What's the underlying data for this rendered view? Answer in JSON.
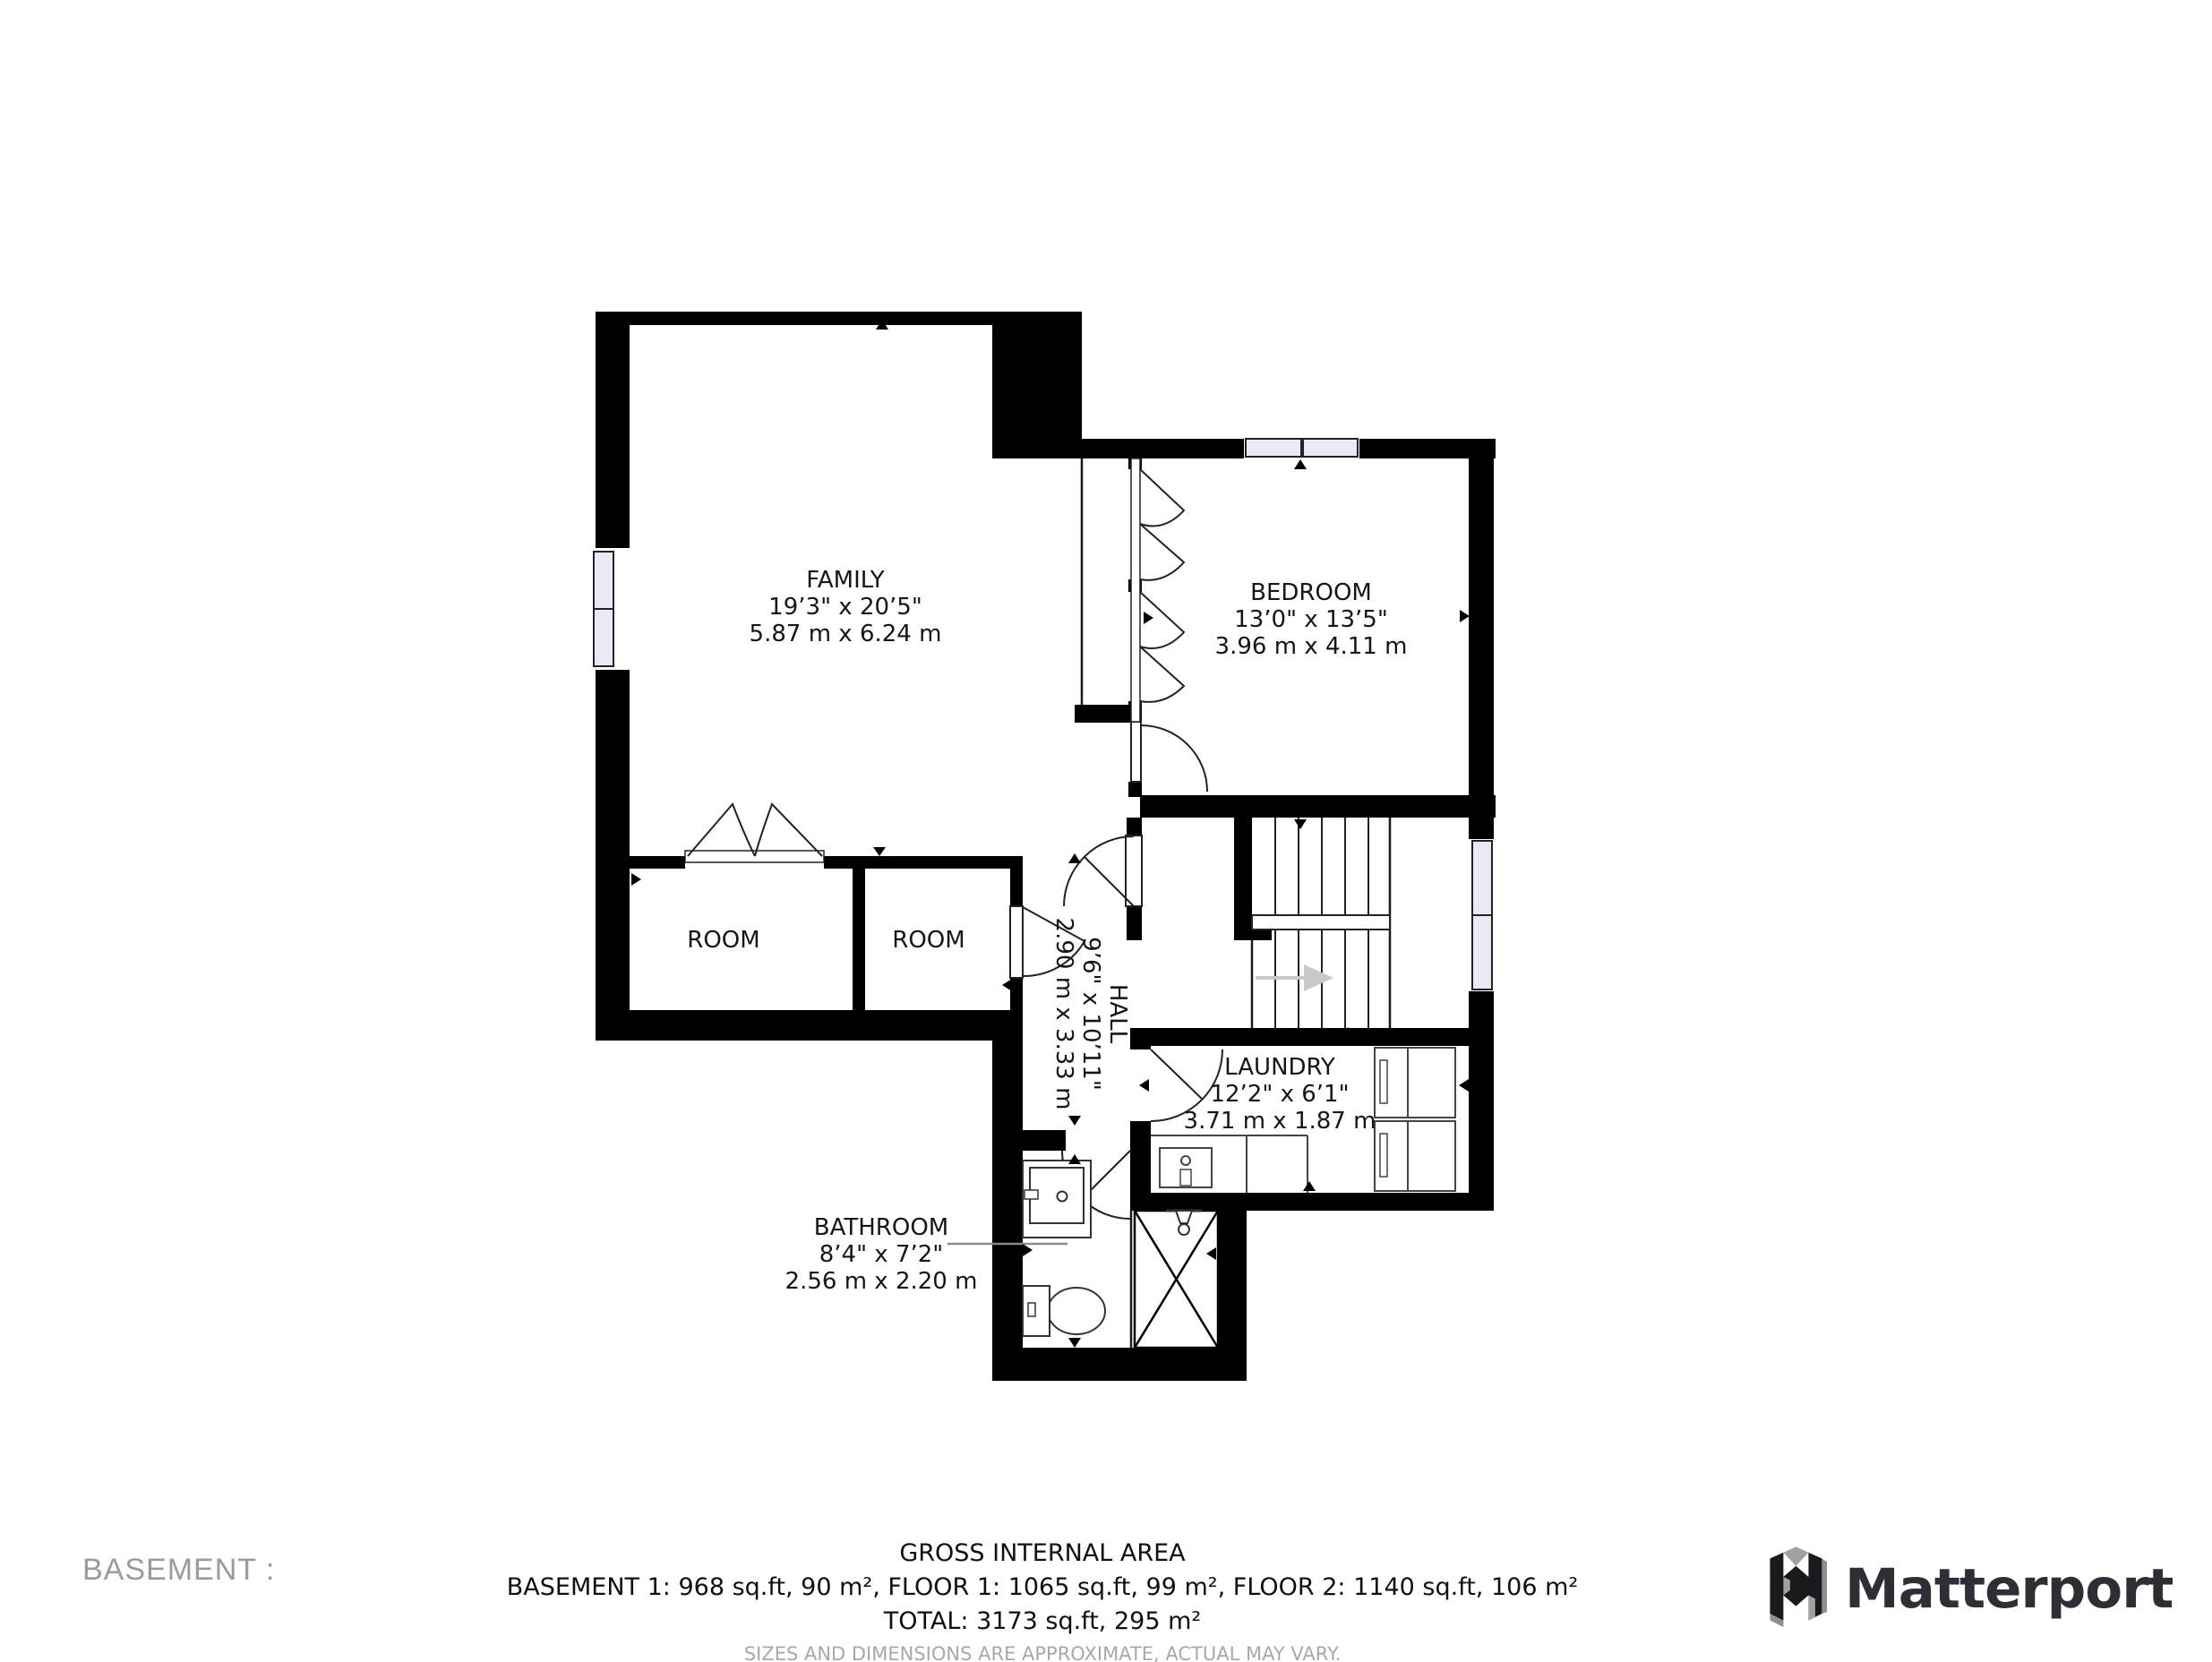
{
  "floorplan": {
    "rooms": {
      "family": {
        "name": "FAMILY",
        "dims_ft": "19’3\" x 20’5\"",
        "dims_m": "5.87 m x 6.24 m"
      },
      "bedroom": {
        "name": "BEDROOM",
        "dims_ft": "13’0\" x 13’5\"",
        "dims_m": "3.96 m x 4.11 m"
      },
      "room_left": {
        "name": "ROOM"
      },
      "room_right": {
        "name": "ROOM"
      },
      "hall": {
        "name": "HALL",
        "dims_ft": "9’6\" x 10’11\"",
        "dims_m": "2.90 m x 3.33 m"
      },
      "laundry": {
        "name": "LAUNDRY",
        "dims_ft": "12’2\" x 6’1\"",
        "dims_m": "3.71 m x 1.87 m"
      },
      "bathroom": {
        "name": "BATHROOM",
        "dims_ft": "8’4\" x 7’2\"",
        "dims_m": "2.56 m x 2.20 m"
      }
    },
    "colors": {
      "wall": "#000000",
      "window_glass": "#e9eaf5",
      "stair_arrow": "#c9c9c9"
    }
  },
  "footer": {
    "floor_label": "BASEMENT :",
    "area_title": "GROSS INTERNAL AREA",
    "area_line": "BASEMENT 1: 968 sq.ft, 90 m², FLOOR 1: 1065 sq.ft, 99 m², FLOOR 2: 1140 sq.ft, 106 m²",
    "total_line": "TOTAL: 3173 sq.ft, 295 m²",
    "disclaimer": "SIZES AND DIMENSIONS ARE APPROXIMATE, ACTUAL MAY VARY.",
    "brand": "Matterport"
  }
}
